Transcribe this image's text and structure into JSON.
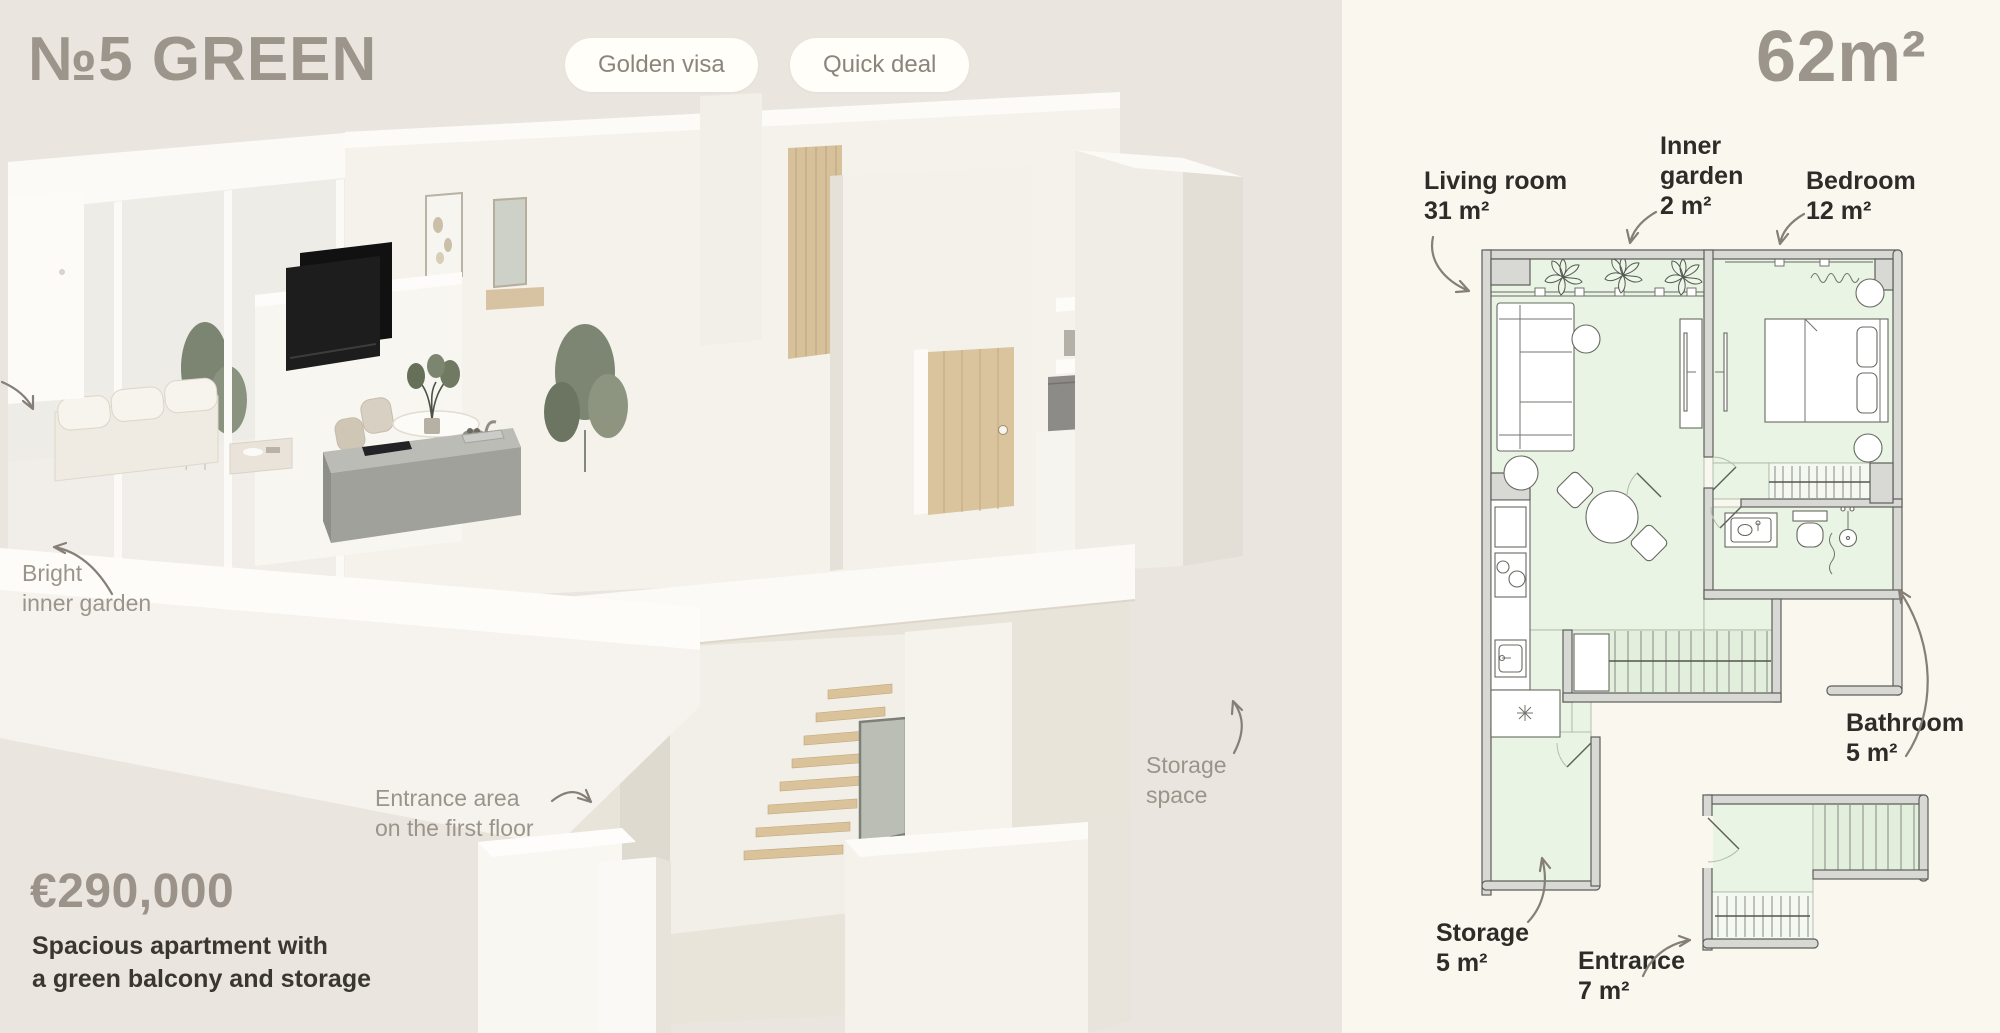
{
  "header": {
    "title": "№5 GREEN",
    "badges": [
      {
        "label": "Golden visa"
      },
      {
        "label": "Quick deal"
      }
    ],
    "area": "62m²"
  },
  "annotations": {
    "garden": {
      "line1": "Bright",
      "line2": "inner garden"
    },
    "entrance": {
      "line1": "Entrance area",
      "line2": "on the first floor"
    },
    "storage": {
      "line1": "Storage",
      "line2": "space"
    }
  },
  "pricing": {
    "price": "€290,000",
    "description_line1": "Spacious apartment with",
    "description_line2": "a green balcony and storage"
  },
  "floor_plan": {
    "rooms": [
      {
        "name": "Living room",
        "area": "31 m²"
      },
      {
        "name": "Inner garden",
        "area": "2 m²"
      },
      {
        "name": "Bedroom",
        "area": "12 m²"
      },
      {
        "name": "Bathroom",
        "area": "5 m²"
      },
      {
        "name": "Storage",
        "area": "5 m²"
      },
      {
        "name": "Entrance",
        "area": "7 m²"
      }
    ]
  },
  "colors": {
    "left_bg": "#ebe5df",
    "right_bg": "#faf7ef",
    "heading": "#9c958b",
    "badge_bg": "#fffef9",
    "badge_text": "#8b857c",
    "annotation": "#9a948a",
    "price": "#9b9389",
    "dark_text": "#3a3733",
    "plan_wall": "#d8d8d5",
    "plan_floor": "#e9f4e5",
    "plan_line": "#5e5e59"
  }
}
